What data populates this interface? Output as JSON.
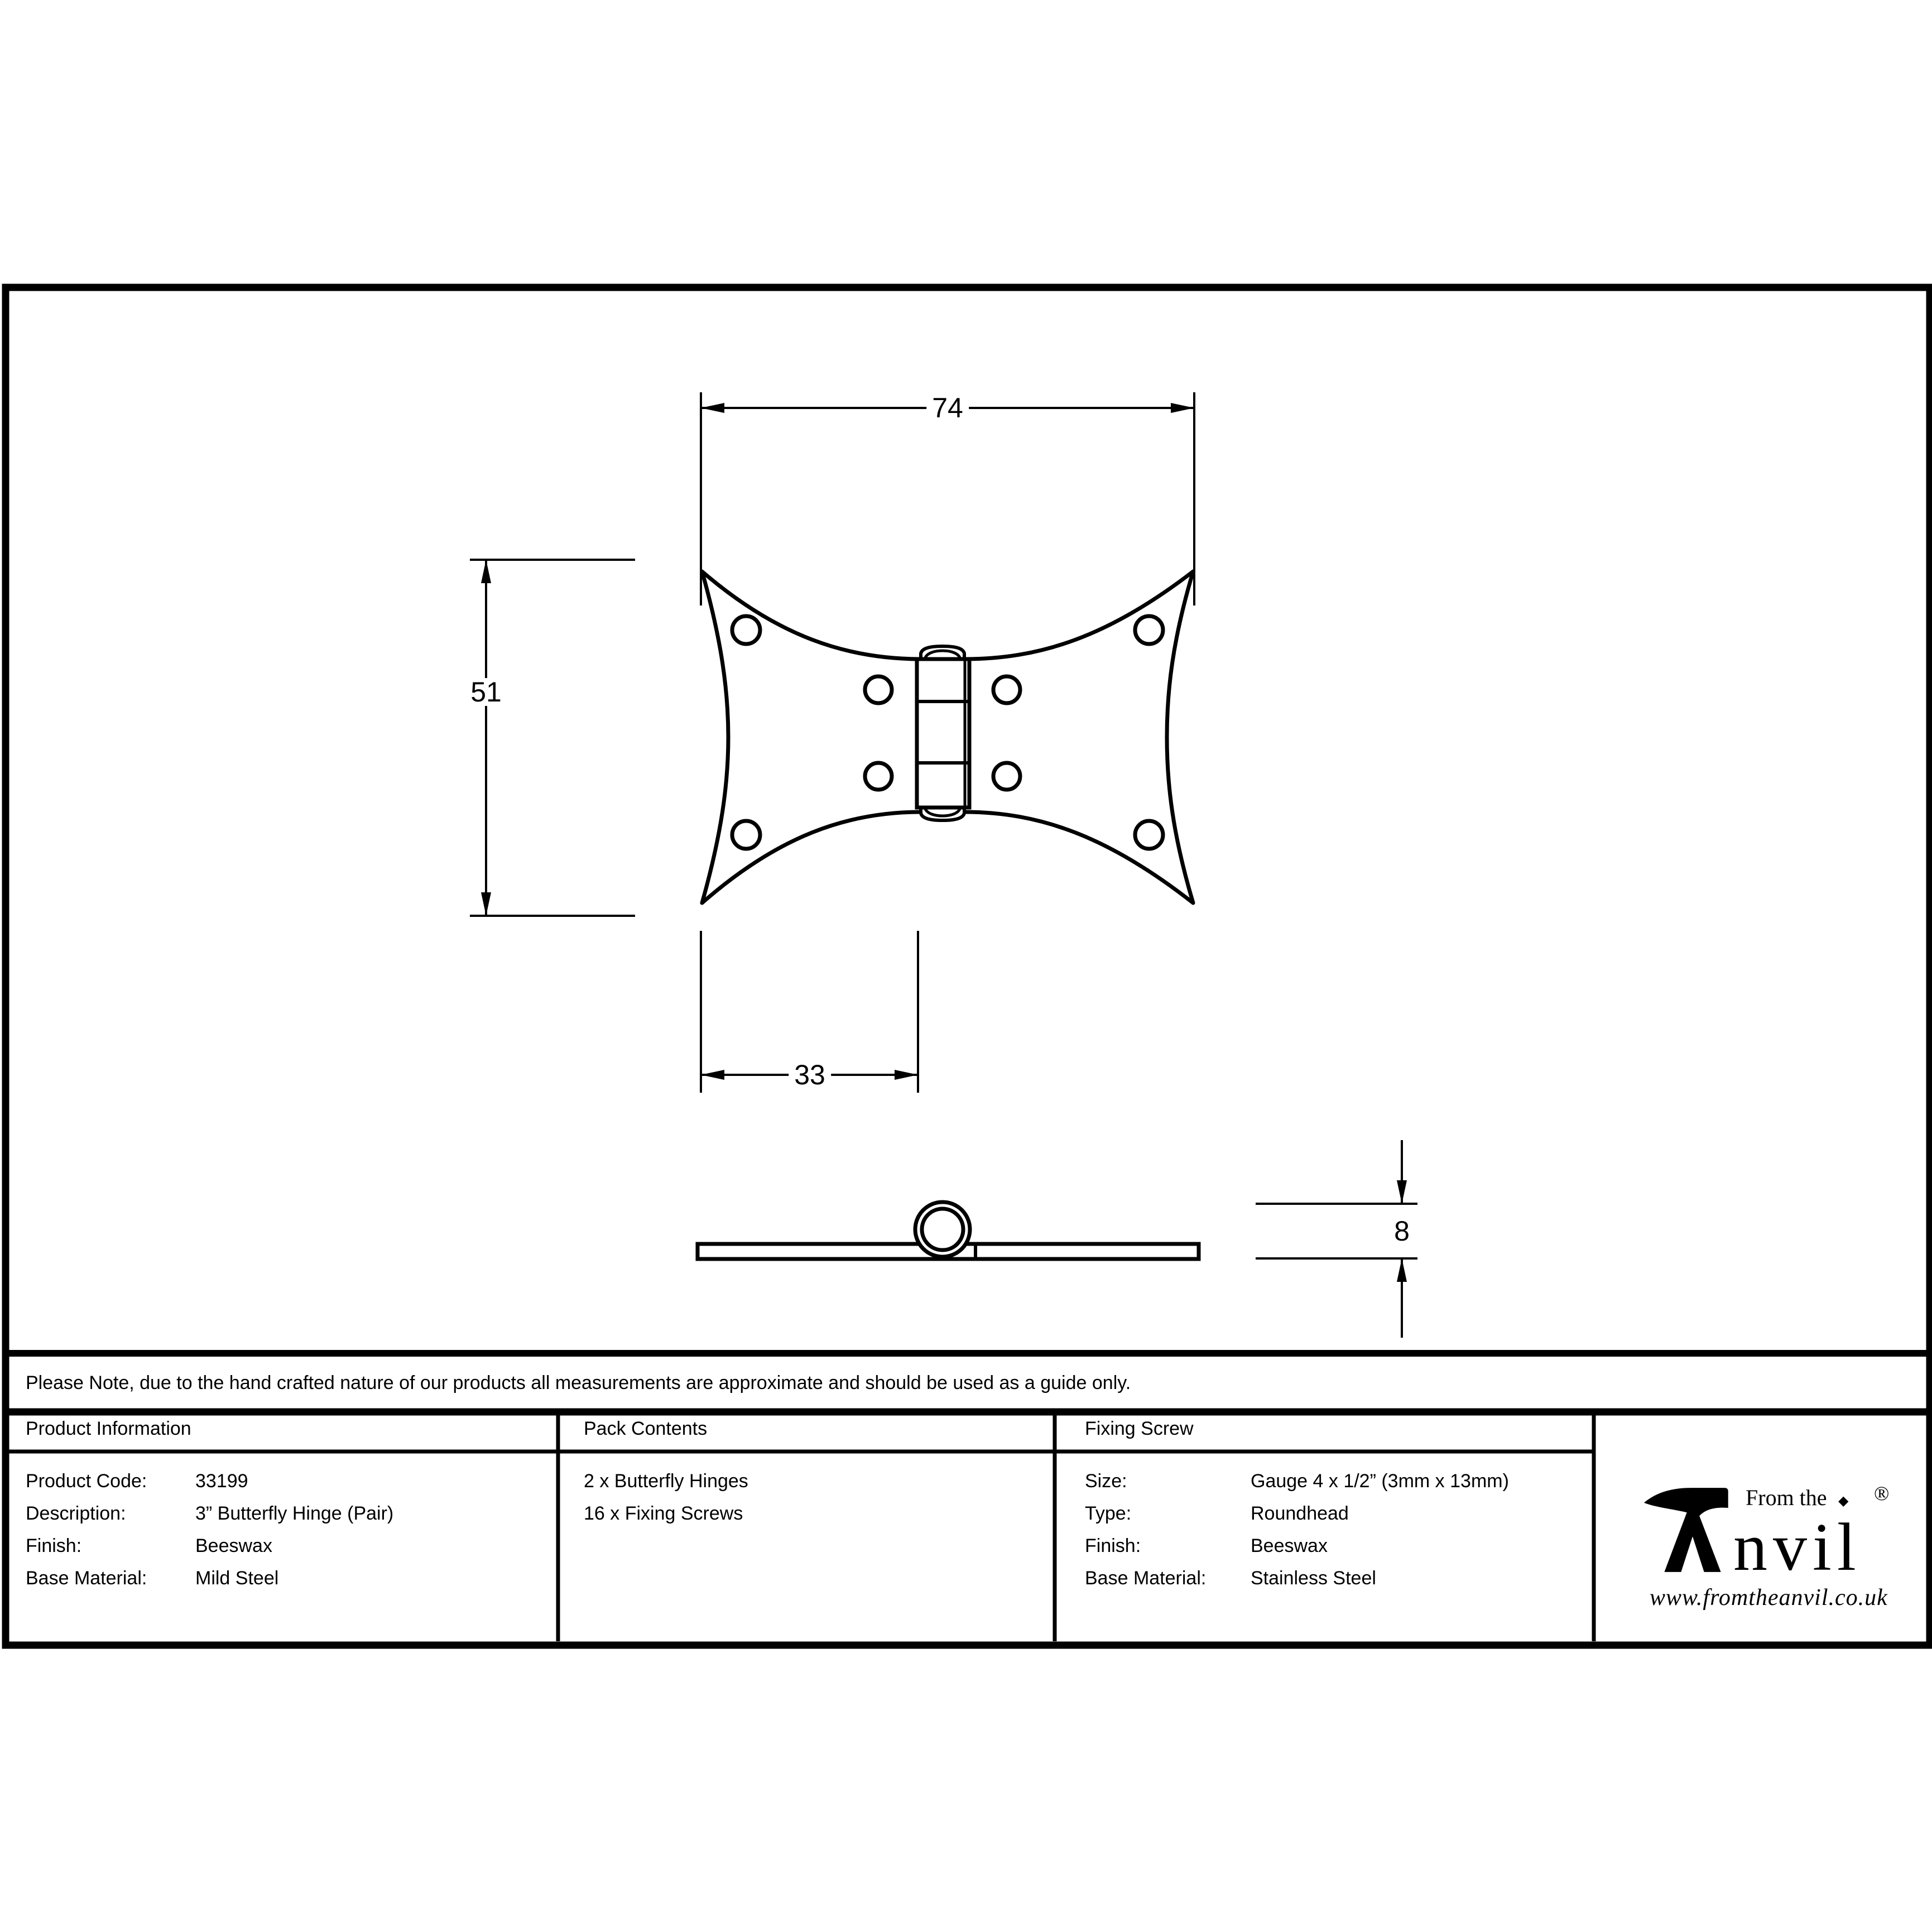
{
  "page": {
    "background": "#ffffff",
    "ink": "#000000"
  },
  "note": {
    "text": "Please Note, due to the hand crafted nature of our products all measurements are approximate and should be used as a guide only."
  },
  "drawing": {
    "plan_view": {
      "width_mm": "74",
      "height_mm": "51",
      "inner_width_mm": "33"
    },
    "side_view": {
      "thickness_mm": "8"
    }
  },
  "table": {
    "product_information": {
      "header": "Product Information",
      "rows": [
        {
          "label": "Product Code:",
          "value": "33199"
        },
        {
          "label": "Description:",
          "value": "3” Butterfly Hinge (Pair)"
        },
        {
          "label": "Finish:",
          "value": "Beeswax"
        },
        {
          "label": "Base Material:",
          "value": "Mild Steel"
        }
      ]
    },
    "pack_contents": {
      "header": "Pack Contents",
      "items": [
        "2 x Butterfly Hinges",
        "16 x Fixing Screws"
      ]
    },
    "fixing_screw": {
      "header": "Fixing Screw",
      "rows": [
        {
          "label": "Size:",
          "value": "Gauge 4 x 1/2” (3mm x 13mm)"
        },
        {
          "label": "Type:",
          "value": "Roundhead"
        },
        {
          "label": "Finish:",
          "value": "Beeswax"
        },
        {
          "label": "Base Material:",
          "value": "Stainless Steel"
        }
      ]
    }
  },
  "brand": {
    "tagline": "From the",
    "name_rest": "nvil",
    "separator": "◆",
    "registered": "®",
    "url": "www.fromtheanvil.co.uk"
  }
}
